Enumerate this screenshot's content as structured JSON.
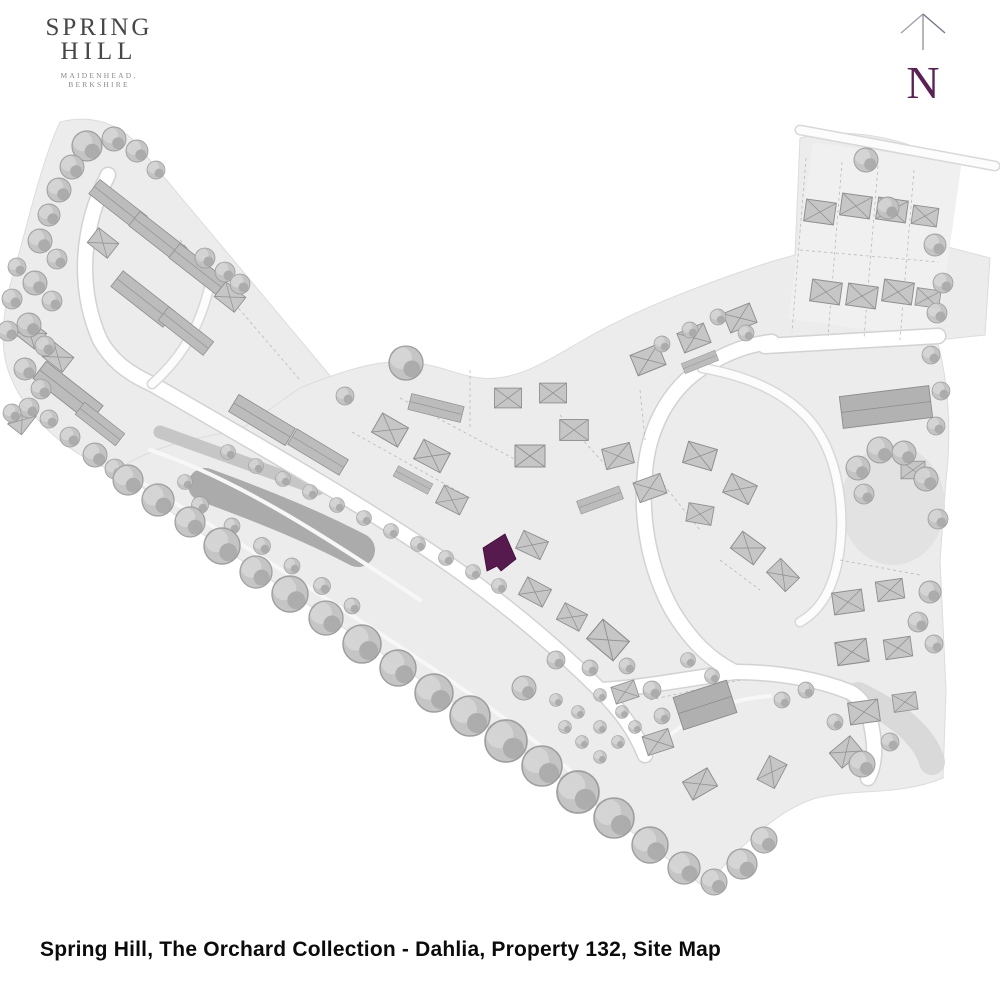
{
  "logo": {
    "title_line1": "SPRING",
    "title_line2": "HILL",
    "tagline": "MAIDENHEAD, BERKSHIRE",
    "color": "#474747"
  },
  "compass": {
    "label": "N",
    "color": "#5c2153"
  },
  "map": {
    "kind": "development site plan",
    "development": "Spring Hill",
    "collection": "The Orchard Collection",
    "house_type": "Dahlia",
    "highlighted_property": "Property 132",
    "highlight_color": "#561a4e",
    "land_color": "#ececec",
    "road_color": "#ffffff",
    "tree_color": "#c2c2c2",
    "pond_color": "#ababab"
  },
  "caption": {
    "text": "Spring Hill, The Orchard Collection - Dahlia, Property 132, Site Map"
  }
}
